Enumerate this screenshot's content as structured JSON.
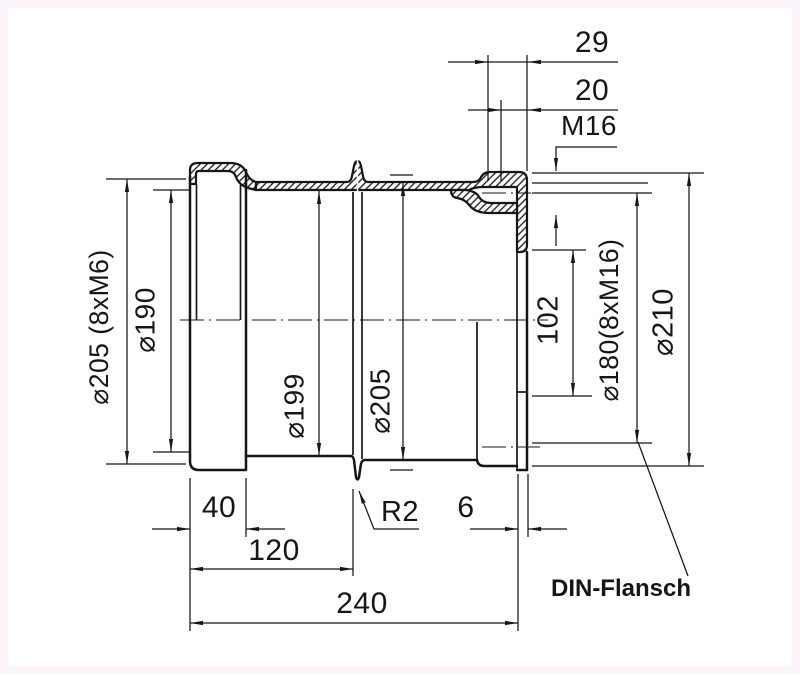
{
  "drawing": {
    "title": "DIN-Flansch technical drawing",
    "colors": {
      "background": "#fcf4fa",
      "paper": "#ffffff",
      "line": "#161616"
    },
    "labels": {
      "flange_note": "DIN-Flansch",
      "thread_note": "M16",
      "radius_note": "R2"
    },
    "dimensions": {
      "length_29": "29",
      "length_20": "20",
      "length_40": "40",
      "length_120": "120",
      "length_240": "240",
      "length_6": "6",
      "length_102": "102",
      "dia_bolt_circle_left": "⌀205 (8xM6)",
      "dia_190": "⌀190",
      "dia_199": "⌀199",
      "dia_205": "⌀205",
      "dia_bolt_circle_right": "⌀180(8xM16)",
      "dia_210": "⌀210"
    }
  }
}
